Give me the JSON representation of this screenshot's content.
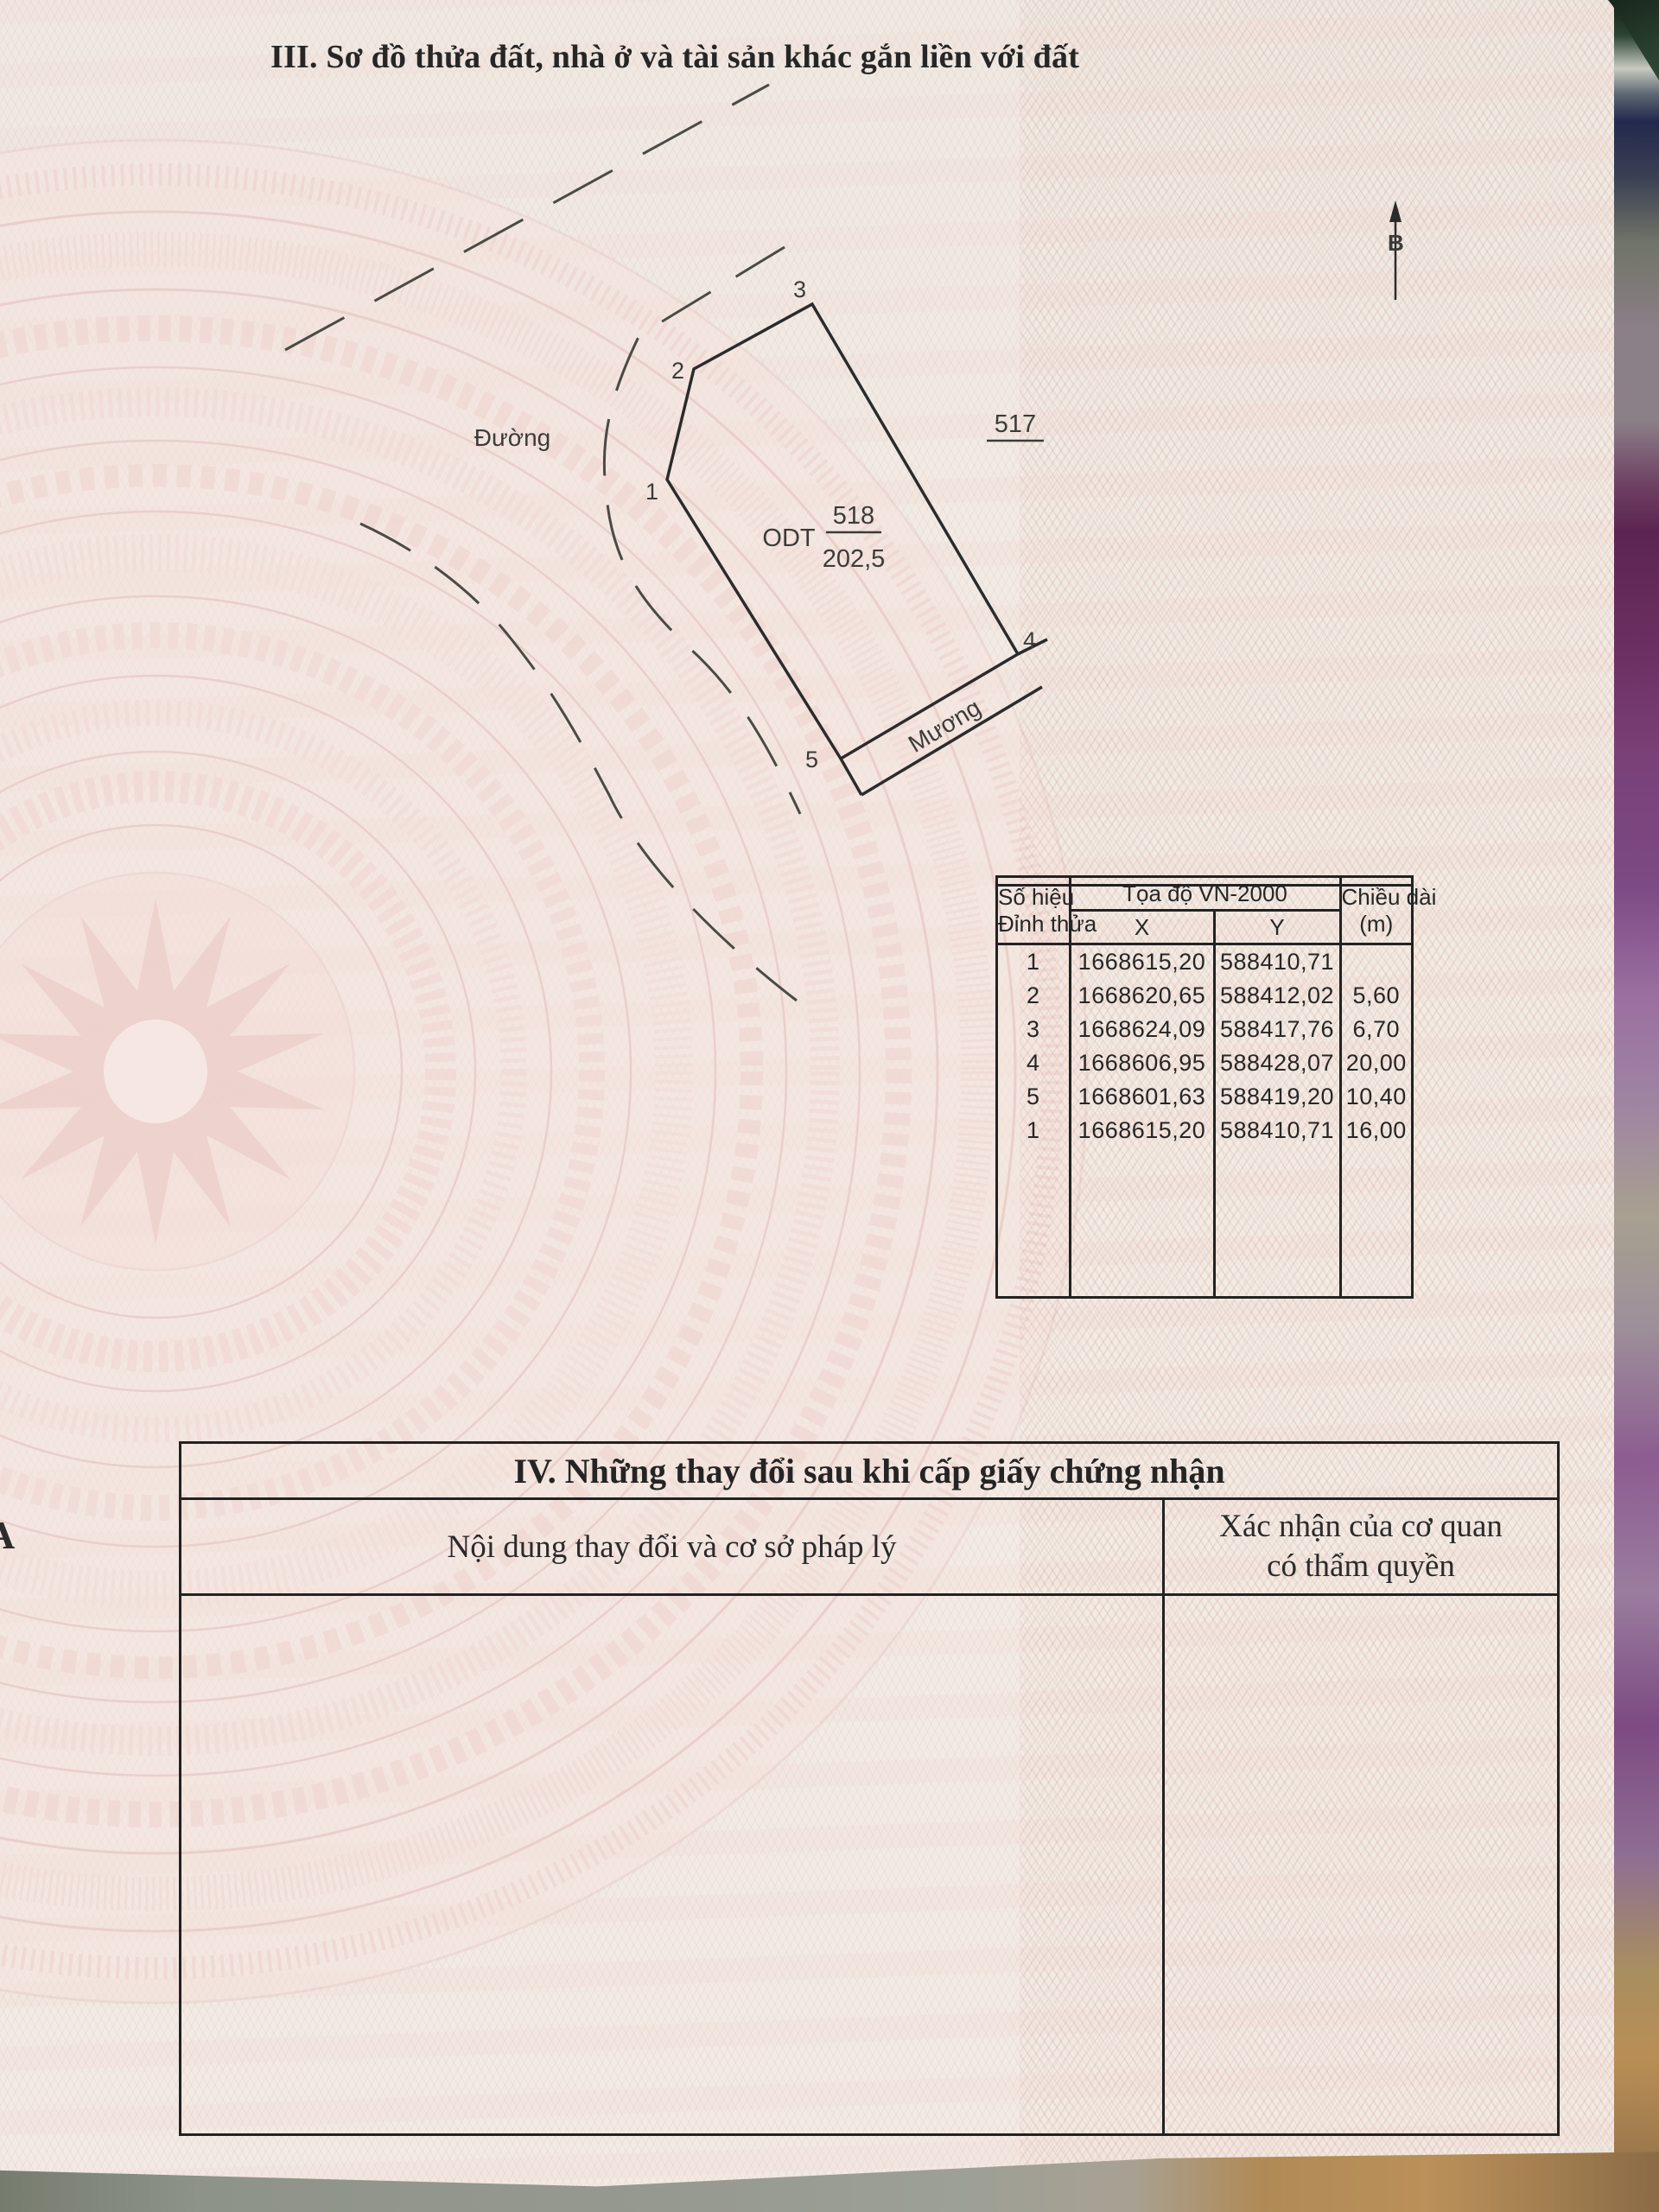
{
  "page": {
    "section3_title": "III. Sơ đồ thửa đất, nhà ở và tài sản khác gắn liền với đất",
    "margin_letter": "A"
  },
  "map": {
    "road_label": "Đường",
    "canal_label": "Mương",
    "adjacent_parcel_number": "517",
    "parcel": {
      "land_use_code": "ODT",
      "number": "518",
      "area": "202,5"
    },
    "vertex_labels": [
      "1",
      "2",
      "3",
      "4",
      "5"
    ],
    "north_label": "B"
  },
  "coord_table": {
    "header": {
      "col_id_line1": "Số hiệu",
      "col_id_line2": "Đỉnh thửa",
      "coord_group": "Tọa độ VN-2000",
      "col_x": "X",
      "col_y": "Y",
      "col_len_line1": "Chiều dài",
      "col_len_line2": "(m)"
    },
    "rows": [
      {
        "id": "1",
        "x": "1668615,20",
        "y": "588410,71",
        "len": ""
      },
      {
        "id": "2",
        "x": "1668620,65",
        "y": "588412,02",
        "len": "5,60"
      },
      {
        "id": "3",
        "x": "1668624,09",
        "y": "588417,76",
        "len": "6,70"
      },
      {
        "id": "4",
        "x": "1668606,95",
        "y": "588428,07",
        "len": "20,00"
      },
      {
        "id": "5",
        "x": "1668601,63",
        "y": "588419,20",
        "len": "10,40"
      },
      {
        "id": "1",
        "x": "1668615,20",
        "y": "588410,71",
        "len": "16,00"
      }
    ]
  },
  "section4": {
    "title": "IV. Những thay đổi sau khi cấp giấy chứng nhận",
    "left_header": "Nội dung thay đổi và cơ sở pháp lý",
    "right_header_line1": "Xác nhận của cơ quan",
    "right_header_line2": "có thẩm quyền"
  }
}
